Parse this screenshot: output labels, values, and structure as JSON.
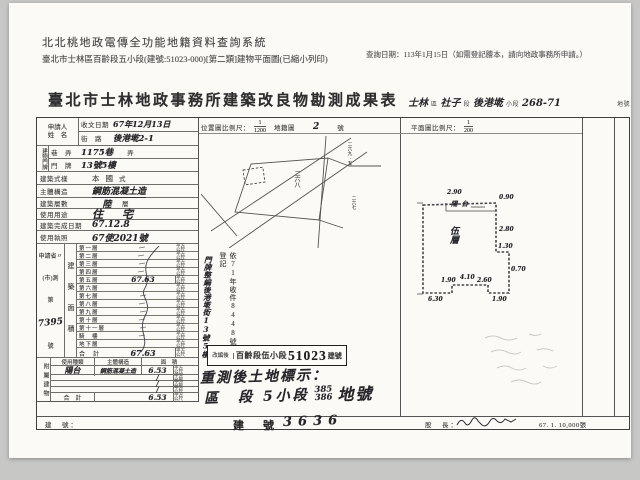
{
  "header": {
    "system_title": "北北桃地政電傳全功能地籍資料查詢系統",
    "query_date": "查詢日期：113年1月15日（如需登記謄本，請向地政事務所申請。）",
    "subtitle": "臺北市士林區百齡段五小段(建號:51023-000)[第二類]建物平面圖(已縮小列印)"
  },
  "form": {
    "title": "臺北市士林地政事務所建築改良物勘測成果表",
    "location": {
      "district": "士林",
      "district_suffix": "區",
      "section": "社子",
      "section_suffix": "段",
      "subsection": "後港墘",
      "subsection_suffix": "小段",
      "parcel": "268-71",
      "parcel_suffix": "地號"
    },
    "applicant": {
      "label_1": "申請人",
      "label_2": "姓　名"
    },
    "fields": {
      "receive_date_label": "收文日期",
      "receive_date": "67年12月13日",
      "address_group_label": "建物門牌",
      "street_label": "街　路",
      "street": "後港墘2-1",
      "lane_label": "巷　弄",
      "lane": "1175巷",
      "lane_suffix": "弄",
      "number_label": "門　牌",
      "number": "13號5樓",
      "style_label": "建築式樣",
      "style": "本國",
      "style_suffix": "式",
      "structure_label": "主體構造",
      "structure": "鋼筋混凝土造",
      "storeys_label": "建築層數",
      "storeys": "陸",
      "storeys_suffix": "層",
      "usage_label": "使用用途",
      "usage": "住　宅",
      "complete_label": "建築完成日期",
      "complete": "67.12.8",
      "license_label": "使用執照",
      "license": "67使2021號"
    },
    "sidebar": {
      "line1": "申請省〃",
      "line2": "(市)測",
      "line3": "第",
      "number": "7395",
      "line4": "號"
    },
    "area_section": {
      "label": "建築面積",
      "unit": "平方公尺",
      "floors": [
        {
          "label": "第一層",
          "value": ""
        },
        {
          "label": "第二層",
          "value": ""
        },
        {
          "label": "第三層",
          "value": ""
        },
        {
          "label": "第四層",
          "value": ""
        },
        {
          "label": "第五層",
          "value": "67.63"
        },
        {
          "label": "第六層",
          "value": ""
        },
        {
          "label": "第七層",
          "value": ""
        },
        {
          "label": "第八層",
          "value": ""
        },
        {
          "label": "第九層",
          "value": ""
        },
        {
          "label": "第十層",
          "value": ""
        },
        {
          "label": "第十一層",
          "value": ""
        },
        {
          "label": "騎　樓",
          "value": ""
        },
        {
          "label": "地下層",
          "value": ""
        },
        {
          "label": "合　計",
          "value": "67.63"
        }
      ]
    },
    "annex": {
      "label": "附屬建物",
      "headers": [
        "使用種類",
        "主體構造",
        "面　積"
      ],
      "rows": [
        {
          "type": "陽台",
          "structure": "鋼筋混凝土造",
          "area": "6.53"
        },
        {
          "type": "",
          "structure": "",
          "area": "/"
        },
        {
          "type": "",
          "structure": "",
          "area": "/"
        },
        {
          "type": "",
          "structure": "",
          "area": "/"
        },
        {
          "type": "合　計",
          "structure": "",
          "area": "6.53"
        }
      ]
    },
    "scales": {
      "location_label": "位置圖比例尺：",
      "location_num": "1",
      "location_den": "1200",
      "sheet_label": "地籍圖",
      "sheet_no": "2",
      "sheet_suffix": "號",
      "plan_label": "平面圖比例尺：",
      "plan_num": "1",
      "plan_den": "200"
    },
    "map": {
      "parcel_label": "二六八",
      "neighbor_top": "二六九-五",
      "neighbor_bottom": "二六七"
    },
    "notes": {
      "reg_note": "依71年收件8448號登記",
      "house_note": "門牌整編後港墘街13號5樓"
    },
    "rebuild": {
      "label": "改編後",
      "section": "百齡段伍小段",
      "number": "51023",
      "suffix": "建號"
    },
    "resurvey": {
      "line1": "重測後土地標示：",
      "line2_prefix": "區　段 5小段",
      "num_top": "385",
      "num_bottom": "386",
      "line2_suffix": "地號"
    },
    "plan": {
      "balcony": "陽台",
      "floor_label": "伍層",
      "dims": [
        "2.90",
        "0.90",
        "2.80",
        "1.30",
        "0.70",
        "1.90",
        "2.60",
        "4.10",
        "1.90",
        "6.30"
      ]
    },
    "bottom": {
      "left_label": "建　號：",
      "center_label": "建　號",
      "center_value": "3636",
      "right_label": "股　長：",
      "print_info": "67. 1. 10,000張"
    }
  }
}
